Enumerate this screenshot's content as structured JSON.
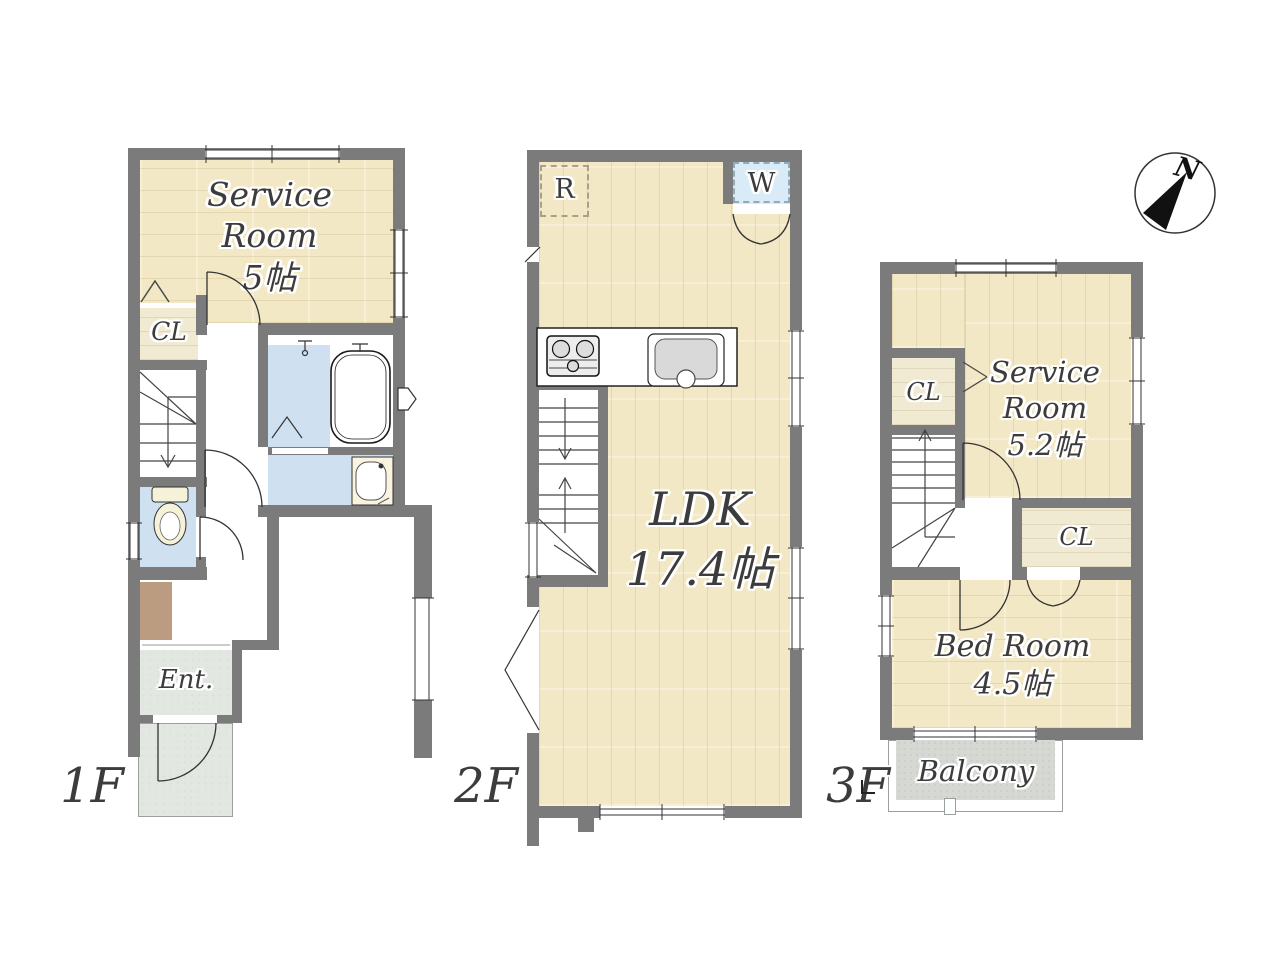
{
  "colors": {
    "wall": "#7b7b7b",
    "wood_floor": "#f3e8c5",
    "water_area": "#cfe1f0",
    "entrance_floor": "#e3e7e1",
    "balcony_floor": "#d6d8d4",
    "step_area": "#bb9c80",
    "washer_box": "#d9ebf7",
    "label_text": "#3c3c3c"
  },
  "compass": {
    "north_label": "N"
  },
  "floor1": {
    "floor_label": "1F",
    "service_room": {
      "line1": "Service",
      "line2": "Room",
      "line3": "5帖"
    },
    "closet_label": "CL",
    "entrance_label": "Ent."
  },
  "floor2": {
    "floor_label": "2F",
    "ldk": {
      "line1": "LDK",
      "line2": "17.4帖"
    },
    "refrigerator_label": "R",
    "washer_label": "W"
  },
  "floor3": {
    "floor_label": "3F",
    "service_room": {
      "line1": "Service",
      "line2": "Room",
      "line3": "5.2帖"
    },
    "closet_upper_label": "CL",
    "closet_lower_label": "CL",
    "bedroom": {
      "line1": "Bed Room",
      "line2": "4.5帖"
    },
    "balcony_label": "Balcony"
  }
}
